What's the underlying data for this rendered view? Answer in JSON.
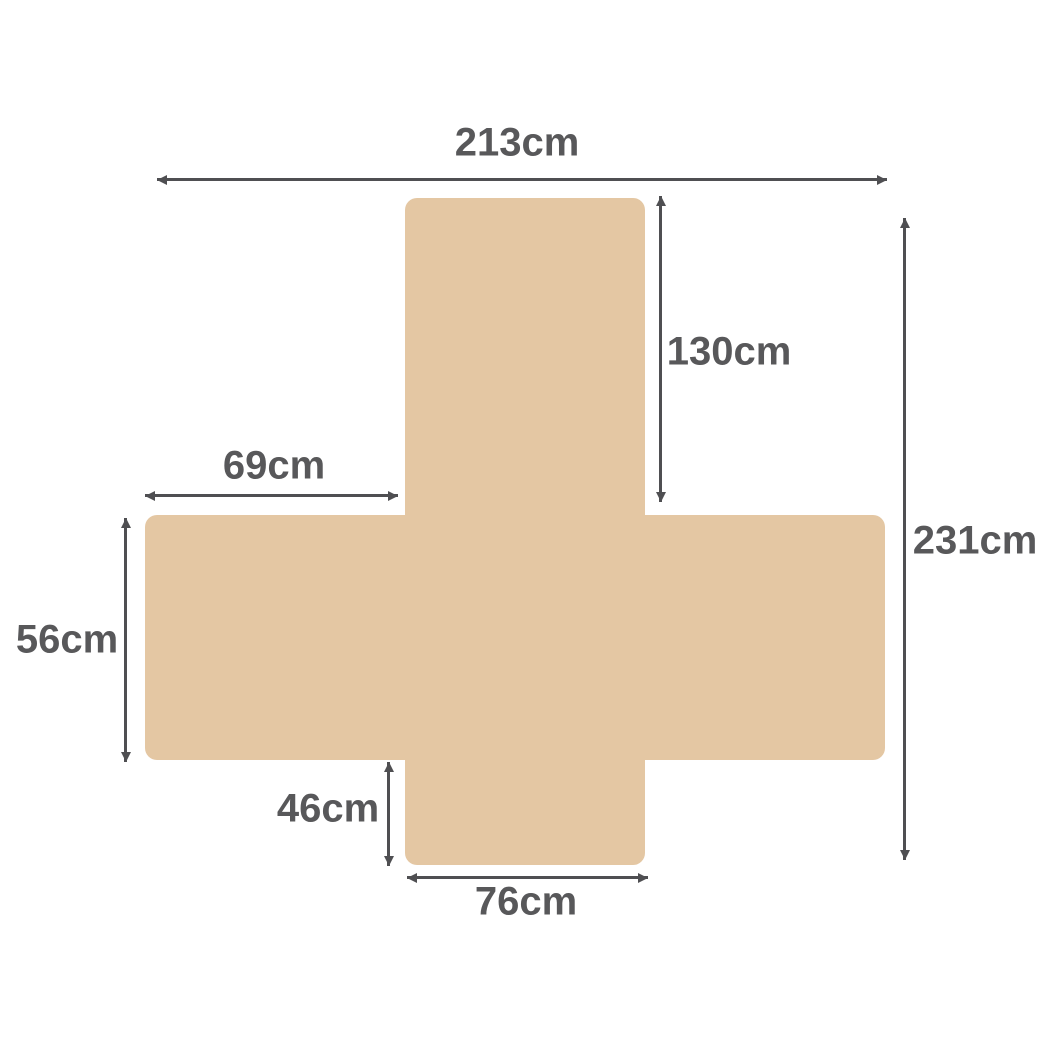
{
  "diagram": {
    "colors": {
      "shape": "#e4c7a3",
      "line": "#4f4f52",
      "text": "#58585a",
      "background": "#ffffff"
    },
    "labels": {
      "top_width": "213cm",
      "back_height": "130cm",
      "left_extension": "69cm",
      "total_height": "231cm",
      "side_height": "56cm",
      "front_height": "46cm",
      "bottom_width": "76cm"
    }
  }
}
